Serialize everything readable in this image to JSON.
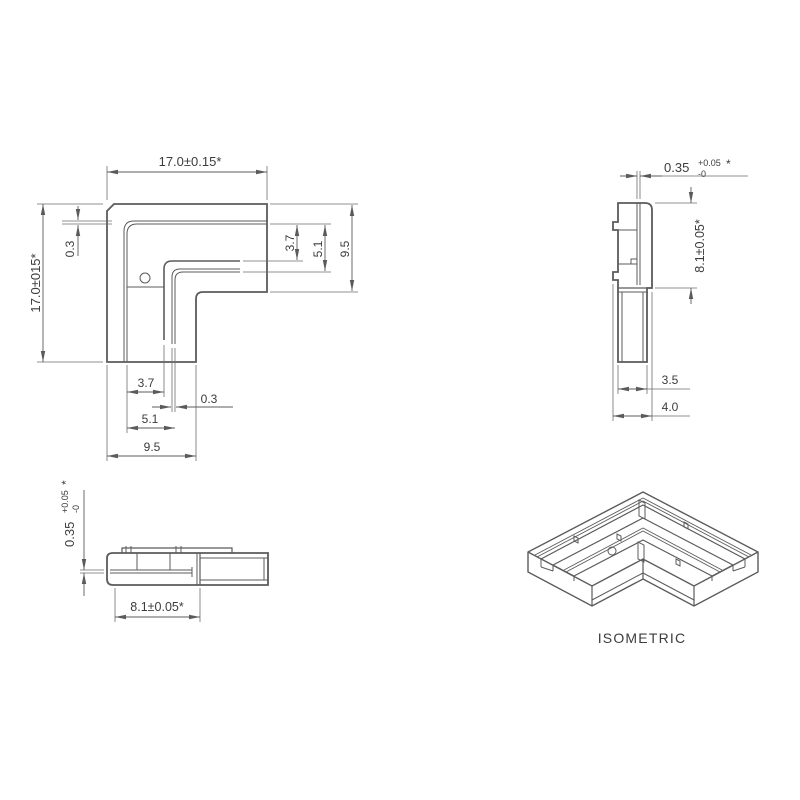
{
  "title": "corner-connector-technical-drawing",
  "style": {
    "background": "#ffffff",
    "edge_color": "#5b5b5b",
    "thin_color": "#6e6e6e",
    "text_color": "#3c3c3c"
  },
  "views": [
    {
      "id": "top-view",
      "paths": [
        {
          "d": "M114,204 L267,204 L267,292 L203,292 Q196,292 196,299 L196,362 L107,362 L107,211 Z",
          "w": 1.8,
          "n": "outer-outline"
        },
        {
          "d": "M267,221 L134,221 Q124,221 124,231 L124,362",
          "w": 1,
          "n": "slot-a-outer-line"
        },
        {
          "d": "M267,224 L137,224 Q127,224 127,234 L127,362",
          "w": 1,
          "n": "slot-a-inner-line"
        },
        {
          "d": "M240,261 L172,261 Q164,261 164,269 L164,340",
          "w": 1.6,
          "n": "inner-wall-line"
        },
        {
          "d": "M240,269 L180,269 Q172,269 172,277 L172,344",
          "w": 1,
          "n": "slot-b-outer-line"
        },
        {
          "d": "M240,272 L183,272 Q175,272 175,280 L175,344",
          "w": 1,
          "n": "slot-b-inner-line"
        },
        {
          "d": "M127,287 L164,287",
          "w": 1,
          "n": "floor-step-line"
        },
        {
          "d": "M107,200 L107,166",
          "w": 0.8,
          "e": 1
        },
        {
          "d": "M267,200 L267,166",
          "w": 0.8,
          "e": 1
        },
        {
          "d": "M103,204 L37,204",
          "w": 0.8,
          "e": 1
        },
        {
          "d": "M103,362 L37,362",
          "w": 0.8,
          "e": 1
        },
        {
          "d": "M112,221 L62,221",
          "w": 0.8,
          "e": 1
        },
        {
          "d": "M112,224 L62,224",
          "w": 0.8,
          "e": 1
        },
        {
          "d": "M270,204 L358,204",
          "w": 0.8,
          "e": 1
        },
        {
          "d": "M270,224 L331,224",
          "w": 0.8,
          "e": 1
        },
        {
          "d": "M243,261 L303,261",
          "w": 0.8,
          "e": 1
        },
        {
          "d": "M243,272 L331,272",
          "w": 0.8,
          "e": 1
        },
        {
          "d": "M270,292 L358,292",
          "w": 0.8,
          "e": 1
        },
        {
          "d": "M107,365 L107,461",
          "w": 0.8,
          "e": 1
        },
        {
          "d": "M127,365 L127,433",
          "w": 0.8,
          "e": 1
        },
        {
          "d": "M164,345 L164,397",
          "w": 0.8,
          "e": 1
        },
        {
          "d": "M172,348 L172,412",
          "w": 0.8,
          "e": 1
        },
        {
          "d": "M175,348 L175,412",
          "w": 0.8,
          "e": 1
        },
        {
          "d": "M196,365 L196,461",
          "w": 0.8,
          "e": 1
        },
        {
          "d": "M107,172 L267,172",
          "w": 0.9,
          "m": "se"
        },
        {
          "d": "M43,204 L43,362",
          "w": 0.9,
          "m": "se"
        },
        {
          "d": "M78,206 L78,220",
          "w": 0.9,
          "m": "e"
        },
        {
          "d": "M78,256 L78,225",
          "w": 0.9,
          "m": "e"
        },
        {
          "d": "M297,225 L297,260",
          "w": 0.9,
          "m": "se"
        },
        {
          "d": "M325,225 L325,271",
          "w": 0.9,
          "m": "se"
        },
        {
          "d": "M352,205 L352,291",
          "w": 0.9,
          "m": "se"
        },
        {
          "d": "M127,392 L164,392",
          "w": 0.9,
          "m": "se"
        },
        {
          "d": "M152,407 L171,407",
          "w": 0.9,
          "m": "e"
        },
        {
          "d": "M233,407 L176,407",
          "w": 0.9,
          "m": "e"
        },
        {
          "d": "M127,428 L175,428",
          "w": 0.9,
          "m": "se"
        },
        {
          "d": "M107,456 L196,456",
          "w": 0.9,
          "m": "se"
        }
      ],
      "circles": [
        {
          "cx": 145,
          "cy": 278,
          "r": 5,
          "n": "hole"
        }
      ],
      "labels": [
        {
          "t": "17.0±0.15*",
          "x": 190,
          "y": 166,
          "fs": 13
        },
        {
          "t": "17.0±015*",
          "x": 40,
          "y": 283,
          "fs": 13,
          "rot": -90
        },
        {
          "t": "0.3",
          "x": 74,
          "y": 249,
          "fs": 12,
          "rot": -90
        },
        {
          "t": "3.7",
          "x": 294,
          "y": 243,
          "fs": 12,
          "rot": -90
        },
        {
          "t": "5.1",
          "x": 322,
          "y": 249,
          "fs": 12,
          "rot": -90
        },
        {
          "t": "9.5",
          "x": 349,
          "y": 249,
          "fs": 12,
          "rot": -90
        },
        {
          "t": "3.7",
          "x": 146,
          "y": 387,
          "fs": 12
        },
        {
          "t": "0.3",
          "x": 209,
          "y": 403,
          "fs": 12
        },
        {
          "t": "5.1",
          "x": 150,
          "y": 423,
          "fs": 12
        },
        {
          "t": "9.5",
          "x": 152,
          "y": 451,
          "fs": 12
        }
      ]
    },
    {
      "id": "side-view",
      "paths": [
        {
          "d": "M618,203 L645,203 Q652,203 652,210 L652,288 L647,288 L647,362 L618,362 L618,280 L613,280 L613,272 L618,272 L618,230 L613,230 L613,222 L618,222 Z",
          "w": 1.8,
          "n": "outer-outline"
        },
        {
          "d": "M637,203 L637,285",
          "w": 1,
          "n": "slot-line"
        },
        {
          "d": "M640,203 L640,285",
          "w": 1,
          "n": "slot-line"
        },
        {
          "d": "M618,230 L637,230",
          "w": 1
        },
        {
          "d": "M618,264 L631,264",
          "w": 1
        },
        {
          "d": "M631,259 L637,259 L637,264 L631,264 Z",
          "w": 1,
          "n": "clip-step"
        },
        {
          "d": "M618,288 L652,288",
          "w": 1.2
        },
        {
          "d": "M618,292 L647,292",
          "w": 1
        },
        {
          "d": "M622,292 L622,362",
          "w": 1
        },
        {
          "d": "M643,292 L643,362",
          "w": 1
        },
        {
          "d": "M637,199 L637,171",
          "w": 0.8,
          "e": 1
        },
        {
          "d": "M640,199 L640,171",
          "w": 0.8,
          "e": 1
        },
        {
          "d": "M655,203 L697,203",
          "w": 0.8,
          "e": 1
        },
        {
          "d": "M655,288 L697,288",
          "w": 0.8,
          "e": 1
        },
        {
          "d": "M613,284 L613,421",
          "w": 0.8,
          "e": 1
        },
        {
          "d": "M652,292 L652,421",
          "w": 0.8,
          "e": 1
        },
        {
          "d": "M618,365 L618,394",
          "w": 0.8,
          "e": 1
        },
        {
          "d": "M647,365 L647,394",
          "w": 0.8,
          "e": 1
        },
        {
          "d": "M662,176 L748,176",
          "w": 0.8,
          "e": 1
        },
        {
          "d": "M647,389 L690,389",
          "w": 0.8,
          "e": 1
        },
        {
          "d": "M652,416 L690,416",
          "w": 0.8,
          "e": 1
        },
        {
          "d": "M620,176 L637,176",
          "w": 0.9,
          "m": "e"
        },
        {
          "d": "M662,176 L640,176",
          "w": 0.9,
          "m": "e"
        },
        {
          "d": "M691,187 L691,203",
          "w": 0.9,
          "m": "e"
        },
        {
          "d": "M691,304 L691,288",
          "w": 0.9,
          "m": "e"
        },
        {
          "d": "M618,389 L647,389",
          "w": 0.9,
          "m": "se"
        },
        {
          "d": "M613,416 L652,416",
          "w": 0.9,
          "m": "se"
        }
      ],
      "circles": [],
      "labels": [
        {
          "parts": [
            {
              "t": "0.35",
              "dx": 0,
              "dy": 0,
              "fs": 13
            },
            {
              "t": "+0.05",
              "dx": 34,
              "dy": -6,
              "fs": 9
            },
            {
              "t": "-0",
              "dx": 34,
              "dy": 5,
              "fs": 9
            },
            {
              "t": "*",
              "dx": 62,
              "dy": -4,
              "fs": 12
            }
          ],
          "x": 664,
          "y": 172,
          "anchor": "start"
        },
        {
          "t": "8.1±0.05*",
          "x": 704,
          "y": 246,
          "fs": 12.5,
          "rot": -90
        },
        {
          "t": "3.5",
          "x": 670,
          "y": 384,
          "fs": 12
        },
        {
          "t": "4.0",
          "x": 670,
          "y": 411,
          "fs": 12
        }
      ]
    },
    {
      "id": "front-view",
      "paths": [
        {
          "d": "M107,558 Q107,553 113,553 L268,553 L268,585 L113,585 Q107,585 107,579 Z",
          "w": 1.8,
          "n": "outer-outline"
        },
        {
          "d": "M122,553 L122,548 L232,548 L232,553",
          "w": 1.2,
          "n": "top-plate"
        },
        {
          "d": "M126,546 L126,553",
          "w": 1
        },
        {
          "d": "M131,546 L131,553",
          "w": 1
        },
        {
          "d": "M176,546 L176,553",
          "w": 1
        },
        {
          "d": "M181,546 L181,553",
          "w": 1
        },
        {
          "d": "M137,553 L137,570",
          "w": 1
        },
        {
          "d": "M170,553 L170,570",
          "w": 1
        },
        {
          "d": "M110,570 L192,570",
          "w": 1,
          "n": "slot-line"
        },
        {
          "d": "M110,573 L192,573",
          "w": 1,
          "n": "slot-line"
        },
        {
          "d": "M192,567 L192,577",
          "w": 1
        },
        {
          "d": "M197,553 L197,585",
          "w": 1
        },
        {
          "d": "M200,553 L200,585",
          "w": 1.2
        },
        {
          "d": "M200,558 L268,558",
          "w": 1
        },
        {
          "d": "M200,580 L268,580",
          "w": 1
        },
        {
          "d": "M264,558 L264,580",
          "w": 1
        },
        {
          "d": "M104,570 L80,570",
          "w": 0.8,
          "e": 1
        },
        {
          "d": "M104,573 L80,573",
          "w": 0.8,
          "e": 1
        },
        {
          "d": "M115,588 L115,622",
          "w": 0.8,
          "e": 1
        },
        {
          "d": "M200,588 L200,622",
          "w": 0.8,
          "e": 1
        },
        {
          "d": "M84,490 L84,570",
          "w": 0.9,
          "m": "e"
        },
        {
          "d": "M84,596 L84,573",
          "w": 0.9,
          "m": "e"
        },
        {
          "d": "M115,617 L200,617",
          "w": 0.9,
          "m": "se"
        }
      ],
      "circles": [],
      "labels": [
        {
          "parts": [
            {
              "t": "0.35",
              "dx": 0,
              "dy": 0,
              "fs": 13
            },
            {
              "t": "+0.05",
              "dx": 34,
              "dy": -6,
              "fs": 9
            },
            {
              "t": "-0",
              "dx": 34,
              "dy": 5,
              "fs": 9
            },
            {
              "t": "*",
              "dx": 62,
              "dy": -4,
              "fs": 12
            }
          ],
          "x": 74,
          "y": 547,
          "rot": -90,
          "anchor": "start"
        },
        {
          "t": "8.1±0.05*",
          "x": 157,
          "y": 611,
          "fs": 12.5
        }
      ]
    },
    {
      "id": "isometric-view",
      "paths": [
        {
          "d": "M643,492 L758,552 L758,572 L694,606 L643,579 L592,606 L528,572 L528,552 Z",
          "w": 1.4,
          "f": "#ffffff",
          "n": "silhouette"
        },
        {
          "d": "M758,552 L694,586 L643,559 L592,586 L528,552",
          "w": 1.4,
          "n": "top-face-edges"
        },
        {
          "d": "M694,586 L694,606",
          "w": 1.2
        },
        {
          "d": "M643,559 L643,579",
          "w": 1.2
        },
        {
          "d": "M592,586 L592,606",
          "w": 1.2
        },
        {
          "d": "M694,600 L643,573 L592,600",
          "w": 1,
          "n": "floor-seam"
        },
        {
          "d": "M745,559 L643,505 L541,559",
          "w": 1.2,
          "n": "rim-inner-edge"
        },
        {
          "d": "M745,559 L745,567",
          "w": 1
        },
        {
          "d": "M541,559 L541,567",
          "w": 1
        },
        {
          "d": "M745,567 L733,571",
          "w": 1
        },
        {
          "d": "M541,567 L553,571",
          "w": 1
        },
        {
          "d": "M733,565 L643,518 L553,565",
          "w": 1.2,
          "n": "island-outer-edge"
        },
        {
          "d": "M733,565 L733,571",
          "w": 1
        },
        {
          "d": "M553,565 L553,571",
          "w": 1
        },
        {
          "d": "M712,576 L643,540 L574,576",
          "w": 1.2,
          "n": "island-inner-edge"
        },
        {
          "d": "M712,576 L712,581",
          "w": 1
        },
        {
          "d": "M574,576 L574,581",
          "w": 1
        },
        {
          "d": "M733,565 L712,576",
          "w": 1
        },
        {
          "d": "M553,565 L574,576",
          "w": 1
        },
        {
          "d": "M751,555 L643,498 L535,555",
          "w": 0.9,
          "n": "rim-slot-line"
        },
        {
          "d": "M749,557 L643,501 L537,557",
          "w": 0.9,
          "n": "rim-slot-line"
        },
        {
          "d": "M722,570 L643,528 L564,570",
          "w": 0.9,
          "n": "island-slot-line"
        },
        {
          "d": "M720,572 L643,531 L566,572",
          "w": 0.9,
          "n": "island-slot-line"
        },
        {
          "d": "M639,500 L639,516 L645,519 L645,503 Z",
          "w": 1,
          "n": "slot-corner-post"
        },
        {
          "d": "M638,542 L638,559 L644,562 L644,545 Z",
          "w": 1,
          "n": "slot-corner-post"
        },
        {
          "d": "M684,522 L688,524 L688,529 L684,527 Z",
          "w": 1,
          "n": "clip-stub"
        },
        {
          "d": "M574,536 L578,538 L578,543 L574,541 Z",
          "w": 1,
          "n": "clip-stub"
        },
        {
          "d": "M676,559 L680,561 L680,566 L676,564 Z",
          "w": 1,
          "n": "clip-stub"
        },
        {
          "d": "M617,534 L621,536 L621,541 L617,539 Z",
          "w": 1,
          "n": "clip-stub"
        }
      ],
      "circles": [
        {
          "cx": 612,
          "cy": 551,
          "r": 4,
          "n": "hole"
        }
      ],
      "labels": [
        {
          "t": "ISOMETRIC",
          "x": 642,
          "y": 643,
          "fs": 14,
          "ls": 1.2,
          "n": "view-caption"
        }
      ]
    }
  ]
}
